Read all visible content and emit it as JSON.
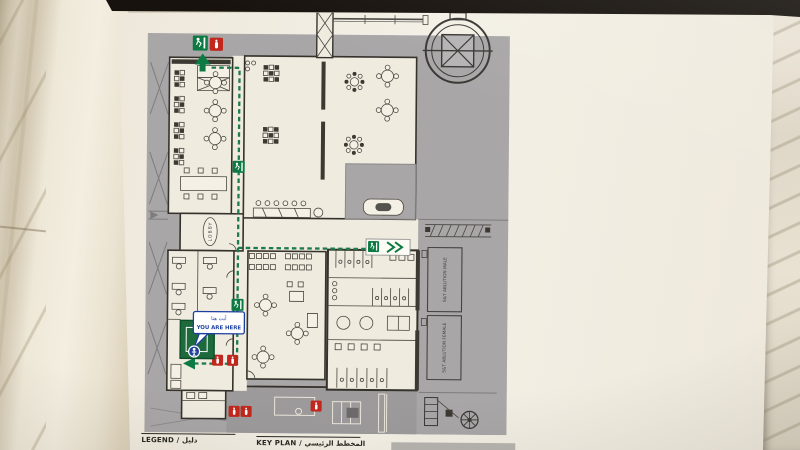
{
  "poster": {
    "you_are_here": {
      "ar": "أنت هنا",
      "en": "YOU ARE HERE"
    },
    "rooms": {
      "lobby": "LOBBY",
      "ablution_male": "S&T ABLUTION MALE",
      "ablution_female": "S&T ABLUTION FEMALE"
    },
    "footer": {
      "legend": "LEGEND / دليل",
      "key_plan": "KEY PLAN / المخطط الرئيسي"
    },
    "icons": {
      "exit_sign": "green running-man exit marker",
      "fire_extinguisher": "red fire-extinguisher marker",
      "you_are_here_pin": "blue person location pin",
      "evacuation_route": "green dashed escape route",
      "spiral_stair": "circular stair structure",
      "fan": "ventilation fan symbol"
    },
    "colors": {
      "route_green": "#1e7b4b",
      "exit_green": "#0d7a43",
      "fire_red": "#c1271d",
      "here_blue": "#1c3f9f",
      "plan_gray": "#a8a6a7",
      "safe_room_green": "#1d6a3c",
      "paper": "#f2ede2",
      "frame_black": "#17120d"
    }
  }
}
